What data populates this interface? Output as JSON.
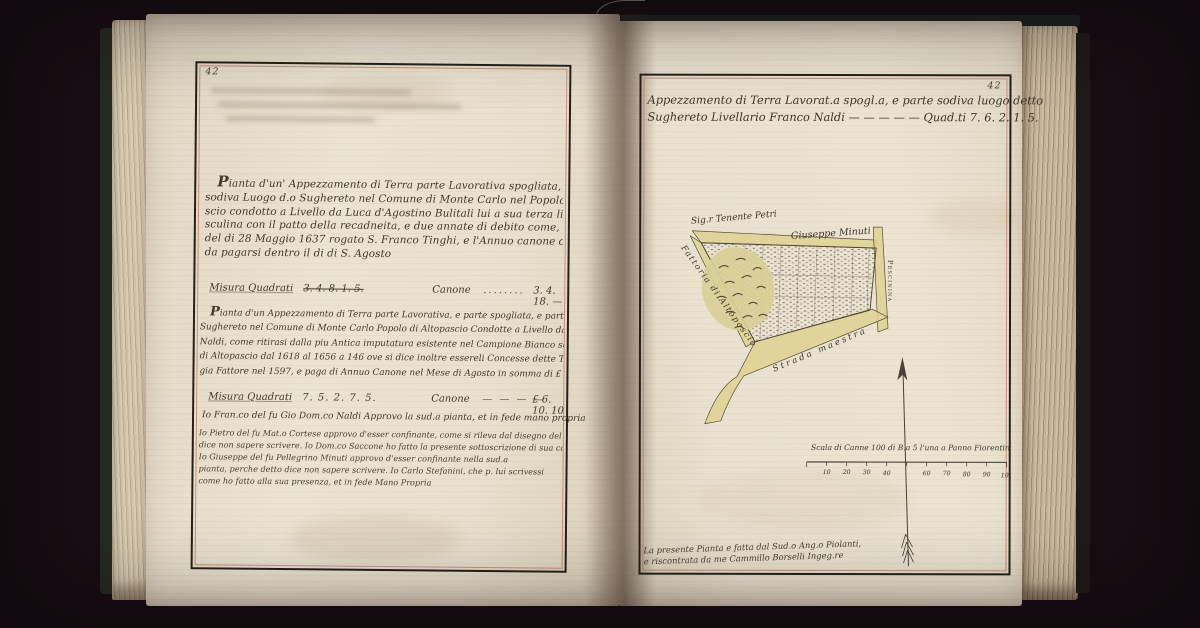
{
  "left_page": {
    "page_number": "42",
    "para1_lines": [
      "Pianta d'un' Appezzamento di Terra parte Lavorativa spogliata, e parte",
      "sodiva Luogo d.o Sughereto nel Comune di Monte Carlo nel Popolo d'Alto pa-",
      "scio condotto a Livello da Luca d'Agostino Bulitali lui a sua terza linea ma-",
      "sculina con il patto della recadneita, e due annate di debito come, e Contratto",
      "del di 28 Maggio 1637 rogato S. Franco Tinghi, e l'Annuo canone di 3. 4. 18. —",
      "da pagarsi dentro il di di S. Agosto"
    ],
    "measure1": {
      "label": "Misura Quadrati",
      "struck_value": "3. 4. 8. 1. 5.",
      "canone_label": "Canone",
      "leader": "........",
      "value": "3. 4. 18. —"
    },
    "para2_lines": [
      "Pianta d'un Appezzamento di Terra parte Lavorativa, e parte spogliata, e parte sodiva luogo detto",
      "Sughereto nel Comune di Monte Carlo Popolo di Altopascio Condotte a Livello da Francesco di Pio Domenico",
      "Naldi, come ritirasi dalla piu Antica imputatura esistente nel Campione Bianco segnato A dei Livelli",
      "di Altopascio dal 1618 al 1656 a 146 ove si dice inoltre essereli Concesse dette Terre da Giovanni Nemini",
      "gia Fattore nel 1597, e paga di Annuo Canone nel Mese di Agosto in somma di £ 6. 10. 10"
    ],
    "measure2": {
      "label": "Misura Quadrati",
      "figures": "7. 5. 2. 7. 5.",
      "canone_label": "Canone",
      "leader": "— — — —",
      "value": "£ 6. 10. 10"
    },
    "attestation_lines": [
      "Io Fran.co del fu Gio Dom.co Naldi Approvo la sud.a pianta, et in fede mano propria",
      "Io Pietro del fu Mat.o Cortese approvo d'esser confinante, come si rileva dal disegno del Sig.r Tenente Petri",
      "dice non sapere scrivere. Io Dom.co Saccone ho fatto la presente sottoscrizione di sua commissione e presenza",
      "Io Giuseppe del fu Pellegrino Minuti approvo d'esser confinante nella sud.a",
      "pianta, perche detto dice non sapere scrivere. Io Carlo Stefanini, che p. lui scrivessi",
      "come ho fatto alla sua presenza, et in fede Mano Propria"
    ]
  },
  "right_page": {
    "page_number": "42",
    "title_line1": "Appezzamento di Terra Lavorat.a spogl.a, e parte sodiva luogo detto",
    "title_line2": "Sughereto Livellario Franco Naldi — — — — — Quad.ti 7. 6. 2. 1. 5.",
    "map_labels": {
      "neighbor_top_left": "Sig.r Tenente Petri",
      "neighbor_top_right": "Giuseppe Minuti",
      "road_left": "Fattoria di Altopascio",
      "road_bottom": "Strada maestra",
      "road_right": "Pescinina"
    },
    "scale": {
      "caption": "Scala di Canne 100 di B.a 5 l'una a Panno Fiorentino",
      "tick_labels": [
        "10",
        "20",
        "30",
        "40",
        "60",
        "70",
        "80",
        "90",
        "100"
      ]
    },
    "credit_line1": "La presente Pianta e fatta dal Sud.o Ang.o Piolanti,",
    "credit_line2": "e riscontrata da me Cammillo Borselli Ingeg.re"
  },
  "colors": {
    "background": "#170e13",
    "paper": "#eae1cd",
    "ink": "#42392c",
    "frame_red": "#bf7568",
    "road_yellow": "#dfd395",
    "wash_olive": "#d8cf97"
  }
}
